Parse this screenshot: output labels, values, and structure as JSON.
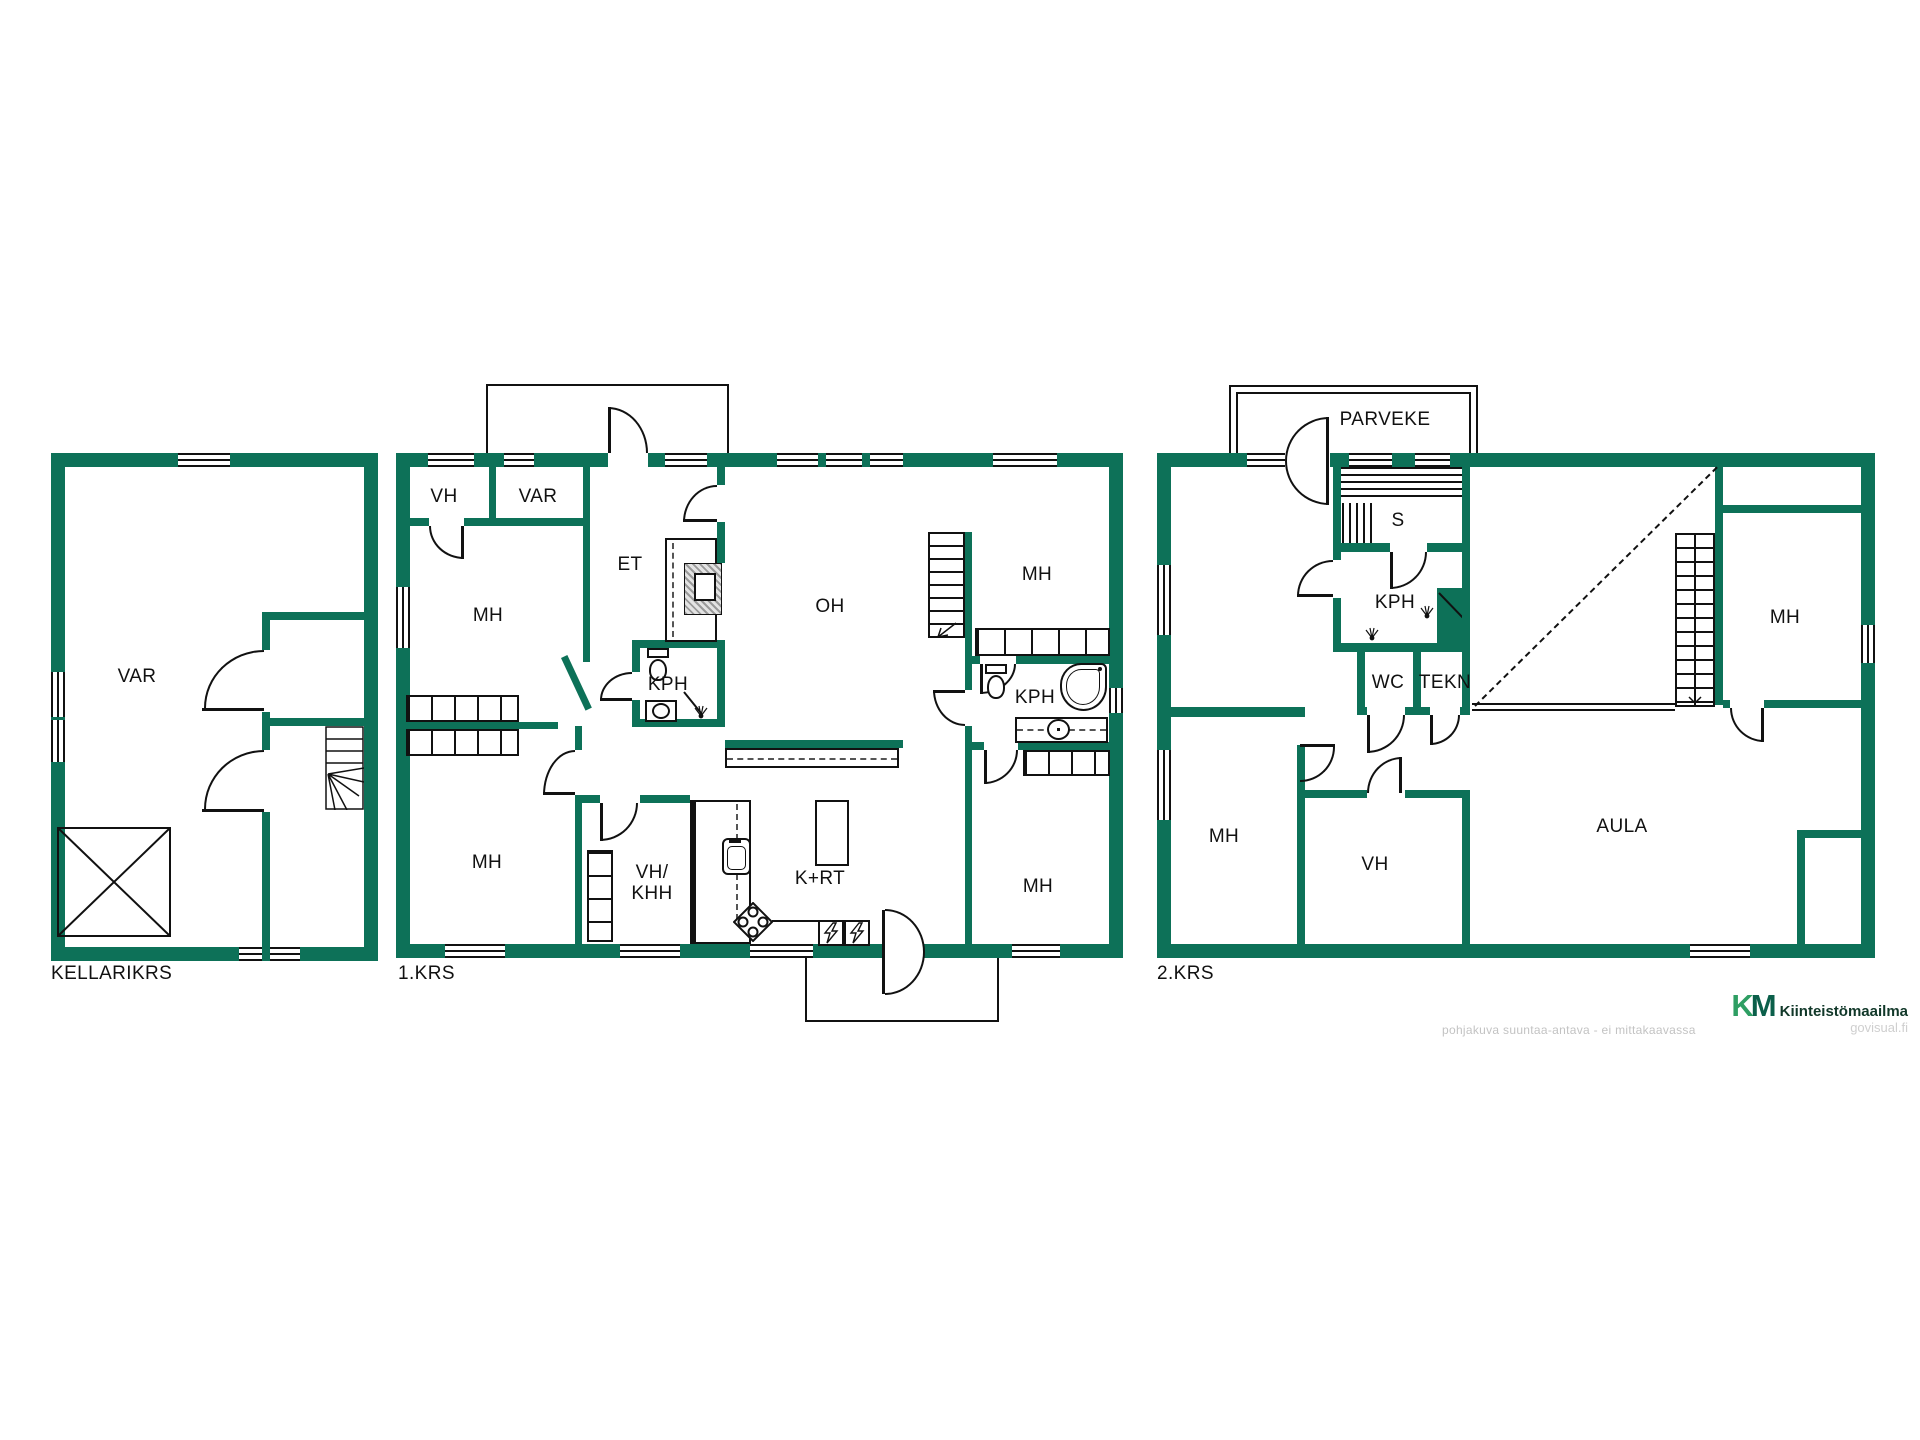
{
  "colors": {
    "wall_green": "#0d7158"
  },
  "floors": [
    {
      "label": "KELLARIKRS",
      "rooms": [
        "VAR"
      ]
    },
    {
      "label": "1.KRS",
      "rooms": [
        "VH",
        "VAR",
        "ET",
        "OH",
        "MH",
        "KPH",
        "MH",
        "KPH",
        "MH",
        "VH/",
        "KHH",
        "K+RT",
        "MH"
      ]
    },
    {
      "label": "2.KRS",
      "rooms": [
        "PARVEKE",
        "S",
        "KPH",
        "WC",
        "TEKN",
        "MH",
        "MH",
        "VH",
        "AULA"
      ]
    }
  ],
  "footer": {
    "disclaimer": "pohjakuva suuntaa-antava - ei mittakaavassa",
    "brand_k": "K",
    "brand_m": "M",
    "brand_name": "Kiinteistömaailma",
    "watermark": "govisual.fi"
  }
}
